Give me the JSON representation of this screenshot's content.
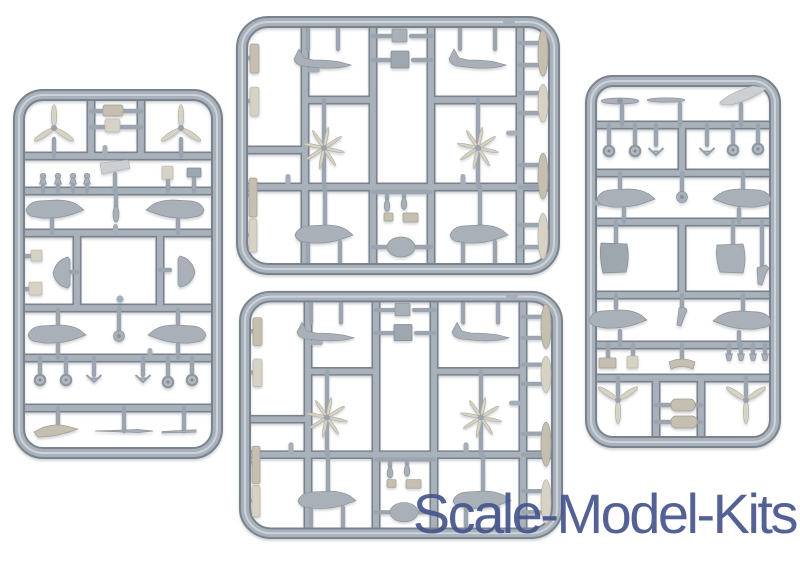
{
  "page": {
    "background_color": "#FFFFFF",
    "width_px": 800,
    "height_px": 562
  },
  "watermark": {
    "text": "Scale-Model-Kits",
    "color": "#47568D"
  },
  "photo": {
    "subject": "Four light-gray injection-molded plastic sprues with small-scale aircraft model parts on a white background",
    "plastic_color": "#A9B2BB",
    "plastic_shadow_color": "#79838E",
    "part_colors": {
      "gray": "#A9B0B7",
      "beige": "#C4BFB1",
      "cream": "#D6D2C5",
      "light": "#CDD0D2"
    },
    "sprues": [
      {
        "id": "sprue-left",
        "position": "left",
        "visible_parts": [
          "two three-blade propellers",
          "two engine blocks",
          "four pawn-shaped pins",
          "wing section",
          "four fuselage halves",
          "two D-shaped floats",
          "four wheels",
          "two V-struts",
          "three wing strips"
        ]
      },
      {
        "id": "sprue-top-center",
        "position": "top center",
        "visible_parts": [
          "four fuselage halves",
          "two multi-blade propellers",
          "two hatch squares",
          "four edge strips",
          "four blade fairings",
          "oval cowling",
          "two teardrop intakes"
        ]
      },
      {
        "id": "sprue-bottom-center",
        "position": "bottom center",
        "visible_parts": [
          "four fuselage halves",
          "two multi-blade propellers",
          "two hatch squares",
          "four edge strips",
          "four blade fairings",
          "oval cowling",
          "two teardrop intakes"
        ]
      },
      {
        "id": "sprue-right",
        "position": "right",
        "visible_parts": [
          "three tailplane blades",
          "four wheels",
          "two V-struts",
          "four fuselage halves",
          "two fin floats",
          "four mushroom pins",
          "two three-blade propellers",
          "two cowling cylinders"
        ]
      }
    ]
  }
}
